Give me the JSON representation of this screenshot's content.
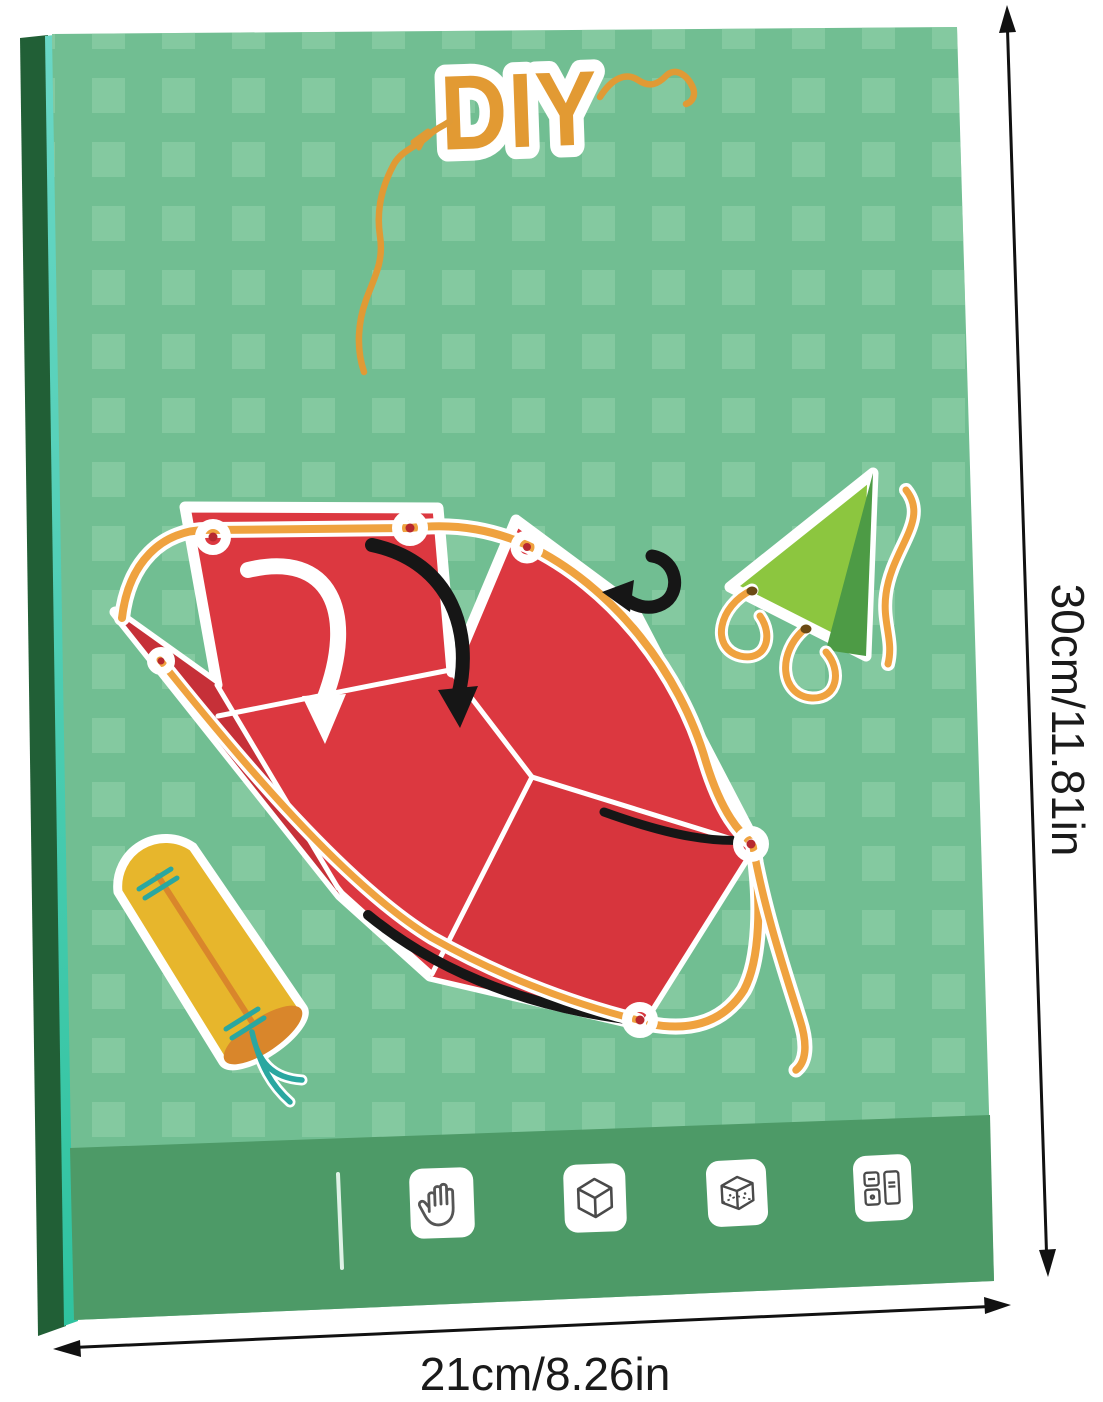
{
  "box": {
    "title": "DIY",
    "footer_icons": [
      {
        "name": "hand"
      },
      {
        "name": "cube"
      },
      {
        "name": "transparent-cube"
      },
      {
        "name": "flashcards"
      }
    ],
    "colors": {
      "front_green": "#71BE92",
      "pattern_square_green": "#8FD0A8",
      "footer_band_green": "#4D9A67",
      "spine_dark_green": "#215F36",
      "spine_teal_highlight": "#55D2BF",
      "title_orange": "#E29A33",
      "string_orange": "#EFA23F",
      "paper_red": "#DC3840",
      "paper_red_shade": "#C63038",
      "triangle_light_green": "#8CC63F",
      "triangle_dark_green": "#4D9B45",
      "cylinder_yellow": "#E7B62C",
      "cylinder_cap_orange": "#D9862B",
      "stitch_teal": "#2AA7A0",
      "arrow_black": "#161616",
      "dimension_black": "#111111"
    }
  },
  "dimensions": {
    "height_label": "30cm/11.81in",
    "width_label": "21cm/8.26in"
  }
}
